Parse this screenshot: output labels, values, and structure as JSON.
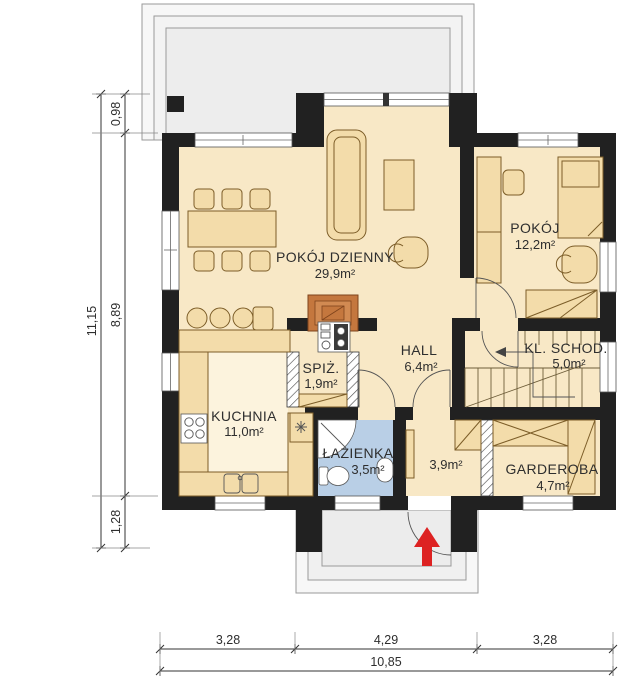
{
  "plan_type": "floor-plan",
  "rooms": {
    "living_room": {
      "name": "POKÓJ DZIENNY",
      "area": "29,9m²"
    },
    "bedroom": {
      "name": "POKÓJ",
      "area": "12,2m²"
    },
    "kitchen": {
      "name": "KUCHNIA",
      "area": "11,0m²"
    },
    "pantry": {
      "name": "SPIŻ.",
      "area": "1,9m²"
    },
    "hall": {
      "name": "HALL",
      "area": "6,4m²"
    },
    "staircase": {
      "name": "KL. SCHOD.",
      "area": "5,0m²"
    },
    "bathroom": {
      "name": "ŁAZIENKA",
      "area": "3,5m²"
    },
    "vestibule": {
      "name": "",
      "area": "3,9m²"
    },
    "wardrobe": {
      "name": "GARDEROBA",
      "area": "4,7m²"
    }
  },
  "dimensions": {
    "left_total": "11,15",
    "terrace_depth": "0,98",
    "body_depth": "8,89",
    "porch_depth": "1,28",
    "bottom_left": "3,28",
    "bottom_center": "4,29",
    "bottom_right": "3,28",
    "bottom_total": "10,85"
  },
  "colors": {
    "wall": "#212121",
    "floor": "#f8e8c6",
    "kitchen_floor": "#fcf3dd",
    "bathroom_floor": "#b9cfe6",
    "furniture": "#f3dcaa",
    "furniture_stroke": "#7c5d28",
    "terrace": "#f1f1f1",
    "fireplace": "#c4773e",
    "entrance_arrow": "#dd2222",
    "text": "#2e2e2e"
  }
}
